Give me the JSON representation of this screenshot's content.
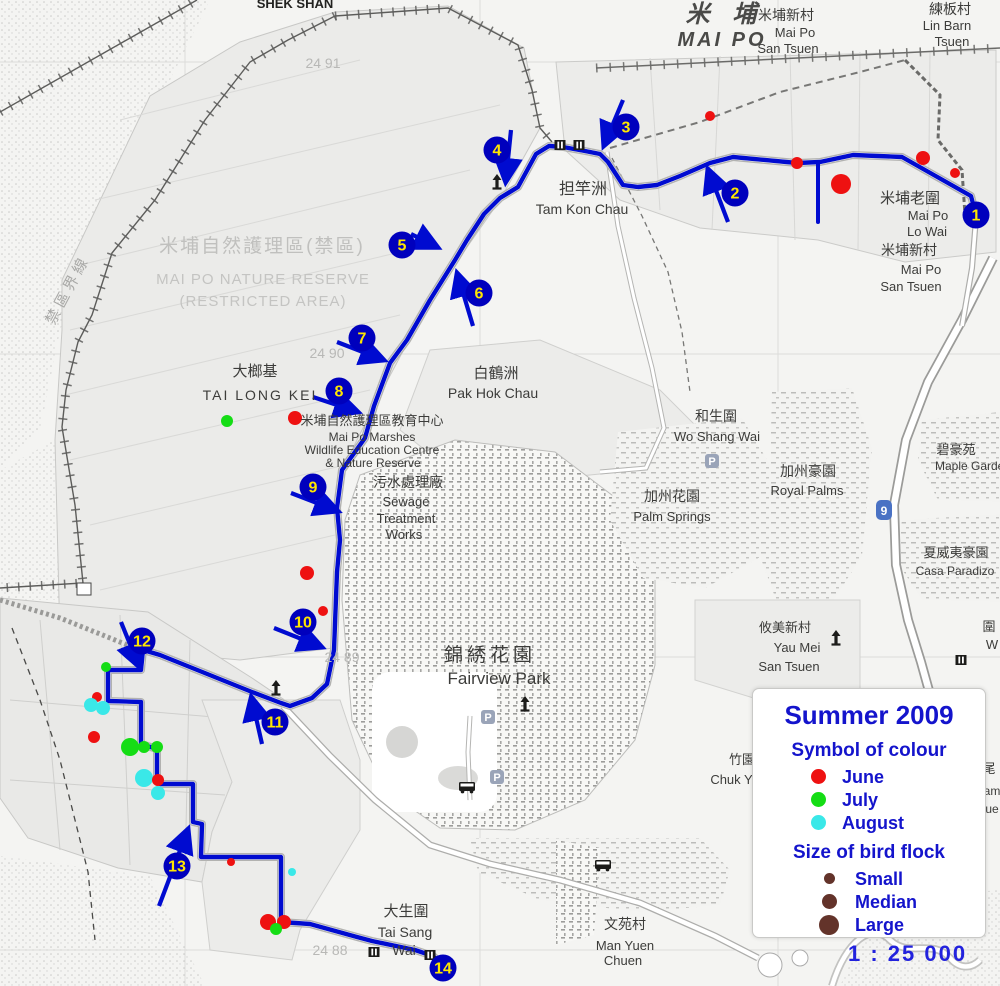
{
  "legend": {
    "title": "Summer 2009",
    "colour_heading": "Symbol of colour",
    "months": [
      {
        "label": "June",
        "color": "#ee1111",
        "d": 15
      },
      {
        "label": "July",
        "color": "#15dd15",
        "d": 15
      },
      {
        "label": "August",
        "color": "#3ae8e8",
        "d": 15
      }
    ],
    "size_heading": "Size of bird flock",
    "sizes": [
      {
        "label": "Small",
        "d": 11
      },
      {
        "label": "Median",
        "d": 15
      },
      {
        "label": "Large",
        "d": 20
      }
    ],
    "size_color": "#63332a"
  },
  "scale_text": "1 : 25 000",
  "map": {
    "colors": {
      "route": "#000bd0",
      "badge": "#0000bd",
      "badge_text": "#ffe600",
      "road_casing": "#b2b2b0"
    },
    "route": [
      [
        976,
        215
      ],
      [
        971,
        196
      ],
      [
        902,
        157
      ],
      [
        853,
        155
      ],
      [
        820,
        162
      ],
      [
        797,
        163
      ],
      [
        733,
        157
      ],
      [
        710,
        163
      ],
      [
        680,
        176
      ],
      [
        657,
        185
      ],
      [
        638,
        187
      ],
      [
        623,
        185
      ],
      [
        608,
        162
      ],
      [
        600,
        154
      ],
      [
        585,
        151
      ],
      [
        563,
        147
      ],
      [
        549,
        146
      ],
      [
        536,
        154
      ],
      [
        518,
        187
      ],
      [
        500,
        198
      ],
      [
        484,
        214
      ],
      [
        467,
        240
      ],
      [
        455,
        260
      ],
      [
        430,
        300
      ],
      [
        407,
        340
      ],
      [
        390,
        363
      ],
      [
        374,
        406
      ],
      [
        365,
        438
      ],
      [
        342,
        470
      ],
      [
        337,
        508
      ],
      [
        340,
        540
      ],
      [
        337,
        572
      ],
      [
        334,
        650
      ],
      [
        327,
        684
      ],
      [
        312,
        698
      ],
      [
        290,
        706
      ],
      [
        281,
        703
      ],
      [
        252,
        692
      ],
      [
        160,
        655
      ],
      [
        143,
        650
      ],
      [
        141,
        670
      ],
      [
        108,
        670
      ],
      [
        108,
        701
      ],
      [
        141,
        702
      ],
      [
        141,
        744
      ],
      [
        157,
        749
      ],
      [
        157,
        781
      ],
      [
        160,
        784
      ],
      [
        193,
        784
      ],
      [
        193,
        822
      ],
      [
        202,
        824
      ],
      [
        201,
        857
      ],
      [
        281,
        857
      ],
      [
        281,
        922
      ],
      [
        310,
        924
      ],
      [
        357,
        937
      ],
      [
        372,
        941
      ],
      [
        415,
        950
      ],
      [
        433,
        956
      ],
      [
        443,
        965
      ]
    ],
    "spur": [
      [
        818,
        163
      ],
      [
        818,
        222
      ]
    ],
    "waypoints": [
      {
        "n": "1",
        "x": 976,
        "y": 215
      },
      {
        "n": "2",
        "x": 735,
        "y": 193
      },
      {
        "n": "3",
        "x": 626,
        "y": 127
      },
      {
        "n": "4",
        "x": 497,
        "y": 150
      },
      {
        "n": "5",
        "x": 402,
        "y": 245
      },
      {
        "n": "6",
        "x": 479,
        "y": 293
      },
      {
        "n": "7",
        "x": 362,
        "y": 338
      },
      {
        "n": "8",
        "x": 339,
        "y": 391
      },
      {
        "n": "9",
        "x": 313,
        "y": 487
      },
      {
        "n": "10",
        "x": 303,
        "y": 622
      },
      {
        "n": "11",
        "x": 275,
        "y": 722
      },
      {
        "n": "12",
        "x": 142,
        "y": 641
      },
      {
        "n": "13",
        "x": 177,
        "y": 866
      },
      {
        "n": "14",
        "x": 443,
        "y": 968
      }
    ],
    "arrows": [
      {
        "x1": 728,
        "y1": 222,
        "x2": 709,
        "y2": 172
      },
      {
        "x1": 623,
        "y1": 100,
        "x2": 605,
        "y2": 143
      },
      {
        "x1": 511,
        "y1": 130,
        "x2": 506,
        "y2": 179
      },
      {
        "x1": 411,
        "y1": 234,
        "x2": 435,
        "y2": 246
      },
      {
        "x1": 473,
        "y1": 326,
        "x2": 458,
        "y2": 276
      },
      {
        "x1": 337,
        "y1": 342,
        "x2": 381,
        "y2": 359
      },
      {
        "x1": 313,
        "y1": 397,
        "x2": 355,
        "y2": 411
      },
      {
        "x1": 291,
        "y1": 493,
        "x2": 335,
        "y2": 510
      },
      {
        "x1": 274,
        "y1": 628,
        "x2": 319,
        "y2": 646
      },
      {
        "x1": 262,
        "y1": 744,
        "x2": 252,
        "y2": 700
      },
      {
        "x1": 121,
        "y1": 622,
        "x2": 138,
        "y2": 664
      },
      {
        "x1": 159,
        "y1": 906,
        "x2": 187,
        "y2": 832
      }
    ],
    "observations": [
      {
        "x": 710,
        "y": 116,
        "month": "June",
        "r": 5
      },
      {
        "x": 797,
        "y": 163,
        "month": "June",
        "r": 6
      },
      {
        "x": 841,
        "y": 184,
        "month": "June",
        "r": 10
      },
      {
        "x": 923,
        "y": 158,
        "month": "June",
        "r": 7
      },
      {
        "x": 955,
        "y": 173,
        "month": "June",
        "r": 5
      },
      {
        "x": 227,
        "y": 421,
        "month": "July",
        "r": 6
      },
      {
        "x": 295,
        "y": 418,
        "month": "June",
        "r": 7
      },
      {
        "x": 307,
        "y": 573,
        "month": "June",
        "r": 7
      },
      {
        "x": 323,
        "y": 611,
        "month": "June",
        "r": 5
      },
      {
        "x": 106,
        "y": 667,
        "month": "July",
        "r": 5
      },
      {
        "x": 97,
        "y": 697,
        "month": "June",
        "r": 5
      },
      {
        "x": 91,
        "y": 705,
        "month": "August",
        "r": 7
      },
      {
        "x": 103,
        "y": 708,
        "month": "August",
        "r": 7
      },
      {
        "x": 94,
        "y": 737,
        "month": "June",
        "r": 6
      },
      {
        "x": 130,
        "y": 747,
        "month": "July",
        "r": 9
      },
      {
        "x": 144,
        "y": 747,
        "month": "July",
        "r": 6
      },
      {
        "x": 157,
        "y": 747,
        "month": "July",
        "r": 6
      },
      {
        "x": 144,
        "y": 778,
        "month": "August",
        "r": 9
      },
      {
        "x": 158,
        "y": 780,
        "month": "June",
        "r": 6
      },
      {
        "x": 158,
        "y": 793,
        "month": "August",
        "r": 7
      },
      {
        "x": 231,
        "y": 862,
        "month": "June",
        "r": 4
      },
      {
        "x": 292,
        "y": 872,
        "month": "August",
        "r": 4
      },
      {
        "x": 268,
        "y": 922,
        "month": "June",
        "r": 8
      },
      {
        "x": 284,
        "y": 922,
        "month": "June",
        "r": 7
      },
      {
        "x": 276,
        "y": 929,
        "month": "July",
        "r": 6
      }
    ],
    "icons": [
      {
        "type": "tower",
        "x": 497,
        "y": 184
      },
      {
        "type": "tower",
        "x": 276,
        "y": 690
      },
      {
        "type": "tower",
        "x": 836,
        "y": 640
      },
      {
        "type": "tower",
        "x": 525,
        "y": 706
      },
      {
        "type": "gate",
        "x": 560,
        "y": 145
      },
      {
        "type": "gate",
        "x": 579,
        "y": 145
      },
      {
        "type": "gate",
        "x": 374,
        "y": 952
      },
      {
        "type": "gate",
        "x": 430,
        "y": 955
      },
      {
        "type": "gate",
        "x": 961,
        "y": 660
      },
      {
        "type": "parking",
        "x": 712,
        "y": 461
      },
      {
        "type": "parking",
        "x": 488,
        "y": 717
      },
      {
        "type": "parking",
        "x": 497,
        "y": 777
      },
      {
        "type": "shield",
        "x": 884,
        "y": 510,
        "label": "9"
      },
      {
        "type": "bus",
        "x": 467,
        "y": 787
      },
      {
        "type": "bus",
        "x": 603,
        "y": 865
      }
    ],
    "labels": [
      {
        "x": 295,
        "y": 8,
        "t": "SHEK SHAN",
        "s": 13,
        "b": 1,
        "c": "#222220"
      },
      {
        "x": 725,
        "y": 22,
        "t": "米 埔",
        "s": 24,
        "b": 1,
        "i": 1,
        "c": "#4a4a48",
        "ls": 8
      },
      {
        "x": 722,
        "y": 46,
        "t": "MAI  PO",
        "s": 20,
        "b": 1,
        "i": 1,
        "c": "#4a4a48",
        "ls": 3
      },
      {
        "x": 786,
        "y": 20,
        "t": "米埔新村",
        "s": 14
      },
      {
        "x": 795,
        "y": 37,
        "t": "Mai Po",
        "s": 13
      },
      {
        "x": 788,
        "y": 53,
        "t": "San Tsuen",
        "s": 13
      },
      {
        "x": 950,
        "y": 14,
        "t": "練板村",
        "s": 14
      },
      {
        "x": 947,
        "y": 30,
        "t": "Lin Barn",
        "s": 13
      },
      {
        "x": 952,
        "y": 46,
        "t": "Tsuen",
        "s": 13
      },
      {
        "x": 323,
        "y": 68,
        "t": "24 91",
        "s": 14,
        "c": "#b8b8b6"
      },
      {
        "x": 262,
        "y": 252,
        "t": "米埔自然護理區(禁區)",
        "s": 19,
        "c": "#c0c0be",
        "ls": 2
      },
      {
        "x": 263,
        "y": 284,
        "t": "MAI  PO  NATURE  RESERVE",
        "s": 15,
        "c": "#c4c4c2",
        "ls": 1
      },
      {
        "x": 263,
        "y": 306,
        "t": "(RESTRICTED AREA)",
        "s": 15,
        "c": "#c4c4c2",
        "ls": 1
      },
      {
        "x": 72,
        "y": 292,
        "t": "禁區界線",
        "s": 15,
        "c": "#a9a9a7",
        "rot": -62,
        "ls": 4
      },
      {
        "x": 583,
        "y": 194,
        "t": "担竿洲",
        "s": 16
      },
      {
        "x": 582,
        "y": 214,
        "t": "Tam Kon Chau",
        "s": 14
      },
      {
        "x": 910,
        "y": 203,
        "t": "米埔老圍",
        "s": 15
      },
      {
        "x": 928,
        "y": 220,
        "t": "Mai Po",
        "s": 13
      },
      {
        "x": 927,
        "y": 236,
        "t": "Lo Wai",
        "s": 13
      },
      {
        "x": 909,
        "y": 255,
        "t": "米埔新村",
        "s": 14
      },
      {
        "x": 921,
        "y": 274,
        "t": "Mai Po",
        "s": 13
      },
      {
        "x": 911,
        "y": 291,
        "t": "San Tsuen",
        "s": 13
      },
      {
        "x": 989,
        "y": 631,
        "t": "圍",
        "s": 13
      },
      {
        "x": 992,
        "y": 649,
        "t": "W",
        "s": 13
      },
      {
        "x": 989,
        "y": 773,
        "t": "尾",
        "s": 13
      },
      {
        "x": 992,
        "y": 795,
        "t": "am",
        "s": 12
      },
      {
        "x": 992,
        "y": 813,
        "t": "ue",
        "s": 12
      },
      {
        "x": 255,
        "y": 376,
        "t": "大榔基",
        "s": 15
      },
      {
        "x": 260,
        "y": 400,
        "t": "TAI  LONG  KEI",
        "s": 14,
        "ls": 2
      },
      {
        "x": 327,
        "y": 358,
        "t": "24 90",
        "s": 14,
        "c": "#b8b8b6"
      },
      {
        "x": 372,
        "y": 425,
        "t": "米埔自然護理區教育中心",
        "s": 13
      },
      {
        "x": 372,
        "y": 441,
        "t": "Mai Po Marshes",
        "s": 12
      },
      {
        "x": 372,
        "y": 454,
        "t": "Wildlife Education Centre",
        "s": 12
      },
      {
        "x": 373,
        "y": 467,
        "t": "& Nature Reserve",
        "s": 12
      },
      {
        "x": 496,
        "y": 378,
        "t": "白鶴洲",
        "s": 15
      },
      {
        "x": 493,
        "y": 398,
        "t": "Pak Hok Chau",
        "s": 14
      },
      {
        "x": 408,
        "y": 487,
        "t": "污水處理廠",
        "s": 14
      },
      {
        "x": 406,
        "y": 506,
        "t": "Sewage",
        "s": 13
      },
      {
        "x": 406,
        "y": 523,
        "t": "Treatment",
        "s": 13
      },
      {
        "x": 404,
        "y": 539,
        "t": "Works",
        "s": 13
      },
      {
        "x": 716,
        "y": 421,
        "t": "和生圍",
        "s": 14
      },
      {
        "x": 717,
        "y": 441,
        "t": "Wo Shang Wai",
        "s": 13
      },
      {
        "x": 672,
        "y": 501,
        "t": "加州花園",
        "s": 14
      },
      {
        "x": 672,
        "y": 521,
        "t": "Palm Springs",
        "s": 13
      },
      {
        "x": 808,
        "y": 476,
        "t": "加州豪園",
        "s": 14
      },
      {
        "x": 807,
        "y": 495,
        "t": "Royal Palms",
        "s": 13
      },
      {
        "x": 956,
        "y": 454,
        "t": "碧豪苑",
        "s": 13
      },
      {
        "x": 973,
        "y": 470,
        "t": "Maple Garden",
        "s": 12
      },
      {
        "x": 956,
        "y": 557,
        "t": "夏威夷豪園",
        "s": 13
      },
      {
        "x": 955,
        "y": 575,
        "t": "Casa Paradizo",
        "s": 12
      },
      {
        "x": 490,
        "y": 661,
        "t": "錦綉花園",
        "s": 19,
        "ls": 4
      },
      {
        "x": 499,
        "y": 684,
        "t": "Fairview Park",
        "s": 17
      },
      {
        "x": 342,
        "y": 662,
        "t": "24 89",
        "s": 14,
        "c": "#b8b8b6"
      },
      {
        "x": 785,
        "y": 632,
        "t": "攸美新村",
        "s": 13
      },
      {
        "x": 797,
        "y": 652,
        "t": "Yau Mei",
        "s": 13
      },
      {
        "x": 789,
        "y": 671,
        "t": "San Tsuen",
        "s": 13
      },
      {
        "x": 742,
        "y": 764,
        "t": "竹園",
        "s": 13
      },
      {
        "x": 742,
        "y": 784,
        "t": "Chuk Yuen",
        "s": 13
      },
      {
        "x": 625,
        "y": 929,
        "t": "文苑村",
        "s": 14
      },
      {
        "x": 625,
        "y": 950,
        "t": "Man Yuen",
        "s": 13
      },
      {
        "x": 623,
        "y": 965,
        "t": "Chuen",
        "s": 13
      },
      {
        "x": 406,
        "y": 916,
        "t": "大生圍",
        "s": 15
      },
      {
        "x": 405,
        "y": 937,
        "t": "Tai Sang",
        "s": 14
      },
      {
        "x": 404,
        "y": 955,
        "t": "Wai",
        "s": 14
      },
      {
        "x": 330,
        "y": 955,
        "t": "24 88",
        "s": 14,
        "c": "#b8b8b6"
      },
      {
        "x": 905,
        "y": 928,
        "t": "Fuk Hing",
        "s": 12,
        "c": "#77776f"
      }
    ]
  }
}
